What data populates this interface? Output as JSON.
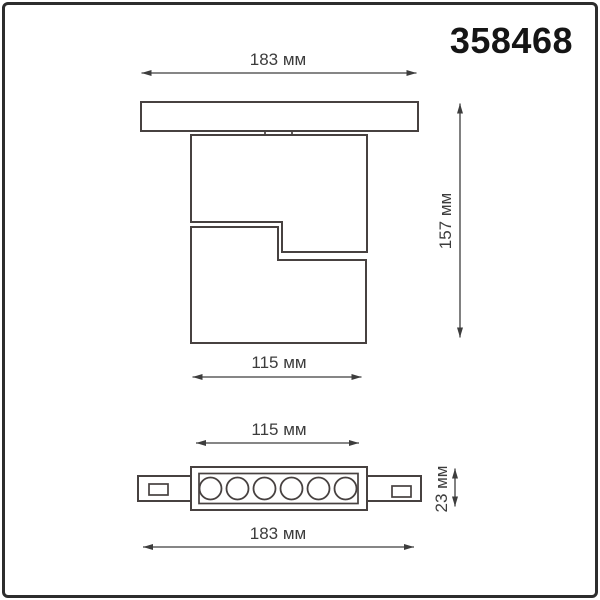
{
  "product_number": "358468",
  "views": {
    "top": {
      "dimensions": {
        "overall_width": {
          "label": "183 мм",
          "value_mm": 183
        },
        "overall_height": {
          "label": "157 мм",
          "value_mm": 157
        },
        "body_width": {
          "label": "115 мм",
          "value_mm": 115
        }
      }
    },
    "bottom": {
      "dimensions": {
        "body_width": {
          "label": "115 мм",
          "value_mm": 115
        },
        "overall_width": {
          "label": "183 мм",
          "value_mm": 183
        },
        "height": {
          "label": "23 мм",
          "value_mm": 23
        }
      },
      "led_count": 6
    }
  },
  "colors": {
    "background": "#ffffff",
    "frame": "#2d2d2d",
    "line": "#474140",
    "dimension": "#3d3d3d",
    "number": "#151515"
  }
}
